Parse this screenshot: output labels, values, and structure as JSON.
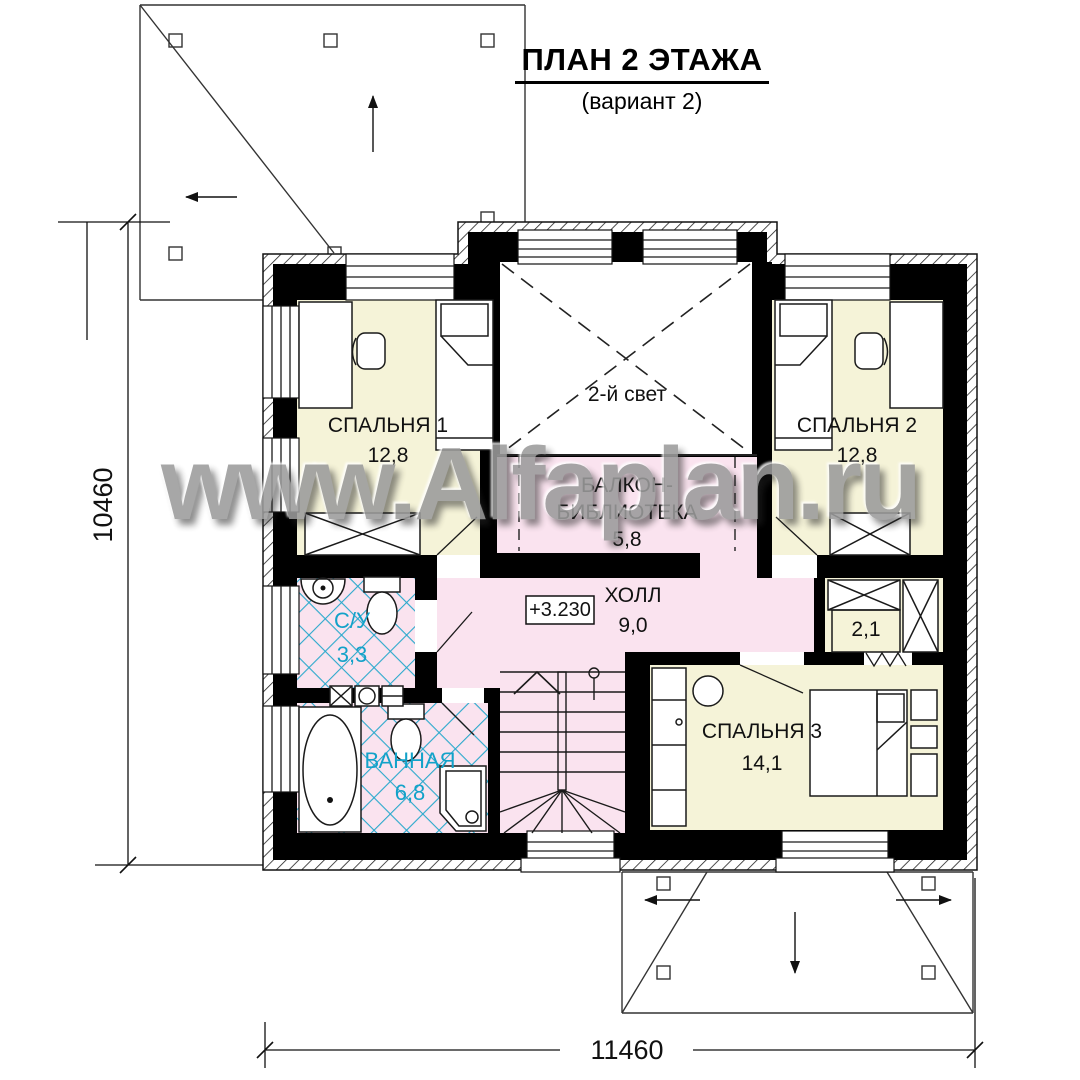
{
  "title": {
    "main": "ПЛАН 2 ЭТАЖА",
    "variant": "(вариант 2)"
  },
  "watermark": "www.Alfaplan.ru",
  "rooms": {
    "bedroom1": {
      "name": "СПАЛЬНЯ 1",
      "area": "12,8"
    },
    "bedroom2": {
      "name": "СПАЛЬНЯ 2",
      "area": "12,8"
    },
    "bedroom3": {
      "name": "СПАЛЬНЯ 3",
      "area": "14,1"
    },
    "void": {
      "name": "2-й свет"
    },
    "balcony": {
      "name_line1": "БАЛКОН-",
      "name_line2": "БИБЛИОТЕКА",
      "area": "5,8"
    },
    "hall": {
      "name": "ХОЛЛ",
      "area": "9,0"
    },
    "wc": {
      "name": "С/У",
      "area": "3,3"
    },
    "bath": {
      "name": "ВАННАЯ",
      "area": "6,8"
    },
    "closet": {
      "area": "2,1"
    }
  },
  "marks": {
    "level": "+3.230"
  },
  "dimensions": {
    "height": "10460",
    "width": "11460"
  },
  "colors": {
    "room_cream": "#f5f3d8",
    "room_pink": "#fae3ef",
    "tile_cyan": "#2aa9cc",
    "label_cyan": "#13a2c9",
    "wall_black": "#000000",
    "watermark_gray": "#9b9b9b"
  }
}
